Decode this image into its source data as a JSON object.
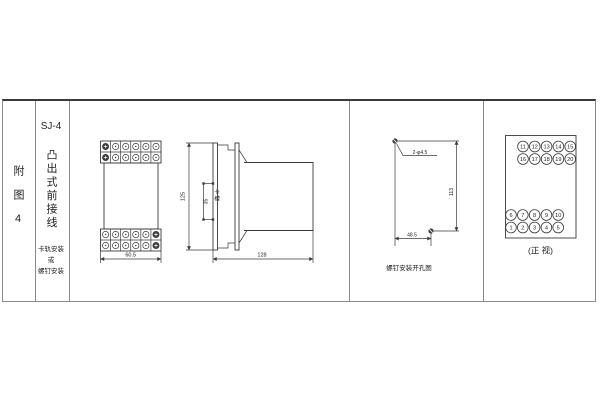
{
  "colors": {
    "line": "#3a3a3a",
    "text": "#222222",
    "grid": "#8a8a8a",
    "background": "#ffffff"
  },
  "sidebar": {
    "figure_label": "附图4",
    "model": "SJ-4",
    "model_desc": "凸出式前接线",
    "mount_line1": "卡轨安装",
    "mount_line2": "或",
    "mount_line3": "螺钉安装"
  },
  "front_view": {
    "width_dim": "60.5"
  },
  "side_view": {
    "height_dim": "125",
    "slot_dim": "35",
    "slot_label": "卡槽",
    "depth_dim": "128"
  },
  "drill_view": {
    "holes_label": "2-φ4.5",
    "height_dim": "113",
    "width_dim": "48.5",
    "caption": "螺钉安装开孔图"
  },
  "terminal_view": {
    "caption": "(正 视)",
    "top_rows": [
      [
        11,
        12,
        13,
        14,
        15
      ],
      [
        16,
        17,
        18,
        19,
        20
      ]
    ],
    "bottom_rows": [
      [
        6,
        7,
        8,
        9,
        10
      ],
      [
        1,
        2,
        3,
        4,
        5
      ]
    ]
  }
}
